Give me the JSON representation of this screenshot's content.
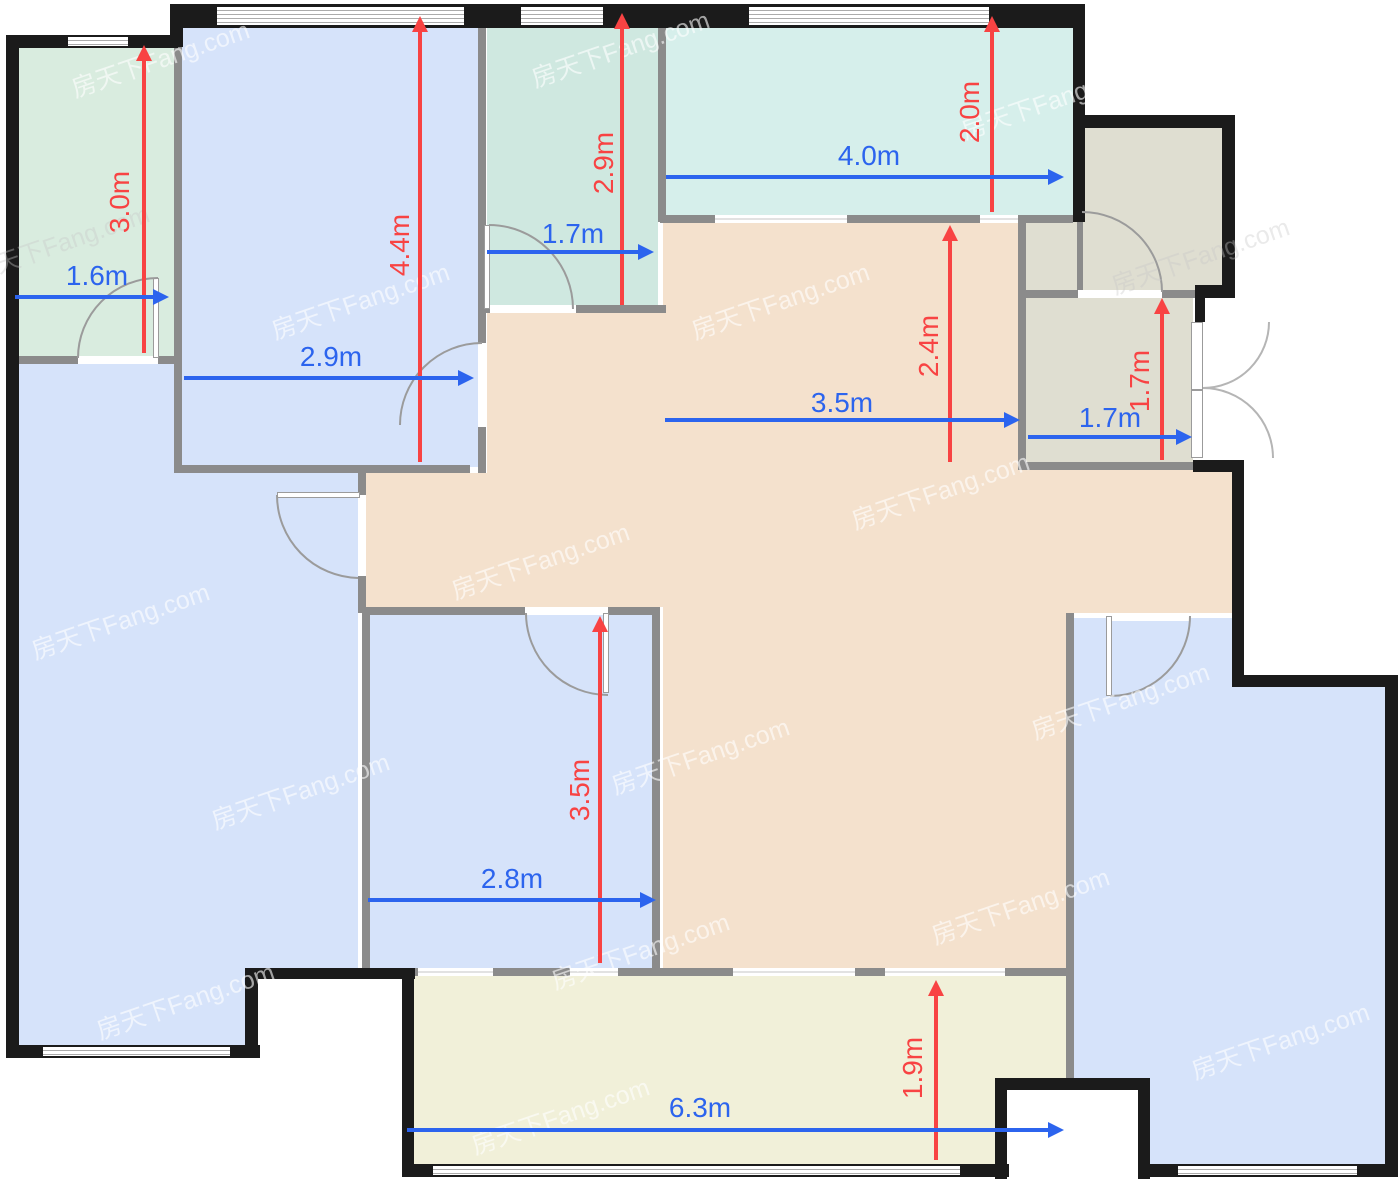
{
  "watermark": {
    "text": "房天下Fang.com"
  },
  "colors": {
    "dimension_red": "#f84343",
    "dimension_blue": "#2c64ee",
    "exterior_wall": "#1b1b1b",
    "interior_wall": "#8b8b8b",
    "room_blue": "#d6e3fa",
    "room_mint": "#cfe8e0",
    "room_teal_balcony": "#d6efeb",
    "room_tan": "#f4e1cd",
    "room_gray": "#dfded1",
    "room_yellow_balcony": "#f1f0d9"
  },
  "dimensions": {
    "vertical": [
      {
        "id": "top-left-room-height",
        "label": "3.0m"
      },
      {
        "id": "top-left-bedroom-height",
        "label": "4.4m"
      },
      {
        "id": "top-middle-room-height",
        "label": "2.9m"
      },
      {
        "id": "top-balcony-height",
        "label": "2.0m"
      },
      {
        "id": "dining-area-height",
        "label": "2.4m"
      },
      {
        "id": "entry-room-height",
        "label": "1.7m"
      },
      {
        "id": "bottom-middle-bedroom-height",
        "label": "3.5m"
      },
      {
        "id": "bottom-balcony-height",
        "label": "1.9m"
      }
    ],
    "horizontal": [
      {
        "id": "top-left-room-width",
        "label": "1.6m"
      },
      {
        "id": "top-left-bedroom-width",
        "label": "2.9m"
      },
      {
        "id": "top-middle-room-width",
        "label": "1.7m"
      },
      {
        "id": "top-balcony-width",
        "label": "4.0m"
      },
      {
        "id": "dining-area-width",
        "label": "3.5m"
      },
      {
        "id": "entry-room-width",
        "label": "1.7m"
      },
      {
        "id": "bottom-middle-bedroom-width",
        "label": "2.8m"
      },
      {
        "id": "bottom-balcony-width",
        "label": "6.3m"
      }
    ]
  }
}
